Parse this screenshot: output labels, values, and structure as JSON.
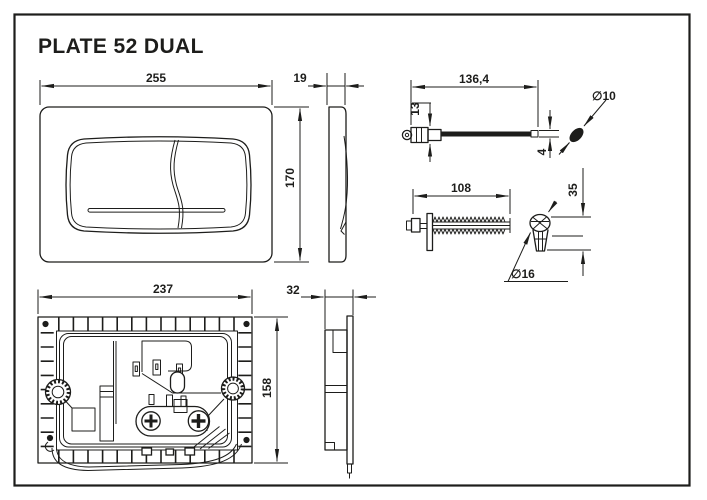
{
  "title": "PLATE 52 DUAL",
  "colors": {
    "ink": "#1d1d1b",
    "paper": "#ffffff"
  },
  "dimensions": {
    "front_width": "255",
    "front_height": "170",
    "plate_thickness": "19",
    "rod_length": "136,4",
    "rod_head_height": "13",
    "rod_tip_height": "4",
    "rod_knob_diameter": "∅10",
    "screw_length": "108",
    "anchor_height": "35",
    "anchor_diameter": "∅16",
    "frame_width": "237",
    "frame_height": "158",
    "frame_depth": "32"
  }
}
